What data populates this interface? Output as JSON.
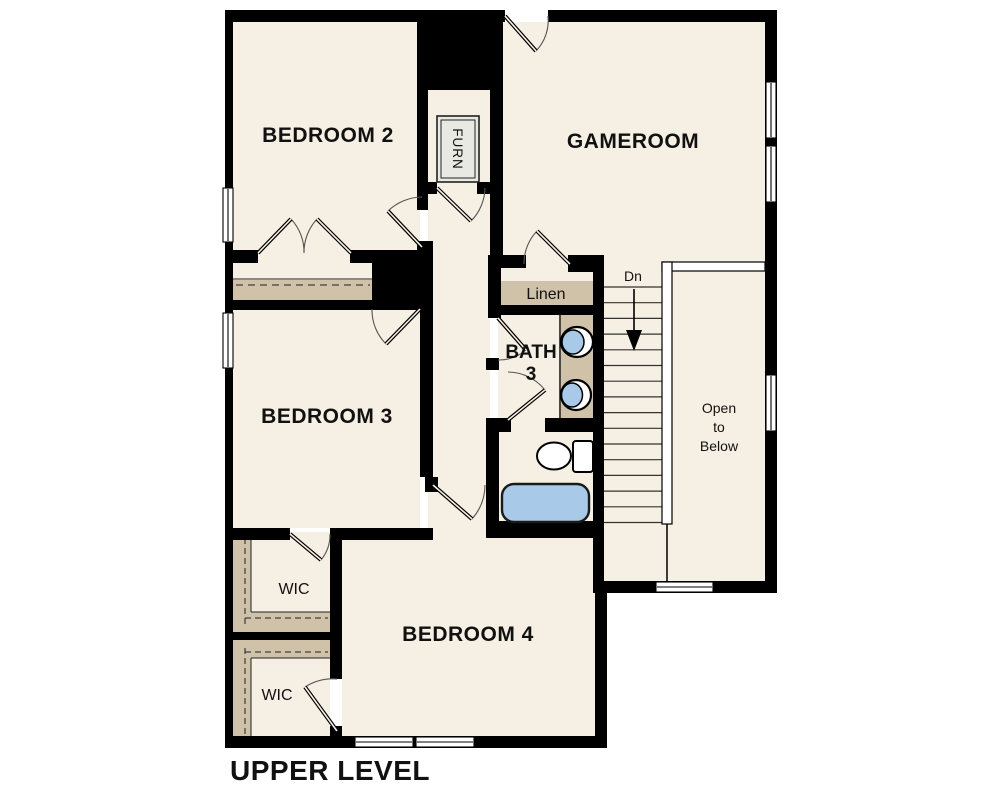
{
  "plan": {
    "title": "UPPER LEVEL",
    "labels": {
      "bedroom2": "BEDROOM 2",
      "gameroom": "GAMEROOM",
      "bedroom3": "BEDROOM 3",
      "bedroom4": "BEDROOM 4",
      "bath3_line1": "BATH",
      "bath3_line2": "3",
      "wic_upper": "WIC",
      "wic_lower": "WIC",
      "linen": "Linen",
      "furn": "FURN",
      "stair_direction": "Dn",
      "open_line1": "Open",
      "open_line2": "to",
      "open_line3": "Below",
      "title": "UPPER LEVEL"
    },
    "stairs": {
      "direction_label": "Dn",
      "tread_count": 16,
      "top_y": 287,
      "step": 15.7,
      "x1": 604,
      "x2": 662
    },
    "fixtures": [
      "double-vanity-sinks",
      "toilet",
      "bathtub",
      "furnace-unit"
    ],
    "colors": {
      "background": "#FFFFFF",
      "floor": "#F6EFE3",
      "wall": "#000000",
      "closet_shelf": "#CFC2A9",
      "fixture_blue": "#A8CAE8",
      "furn_gray": "#E9E9E4",
      "door_arc": "#555555"
    }
  }
}
